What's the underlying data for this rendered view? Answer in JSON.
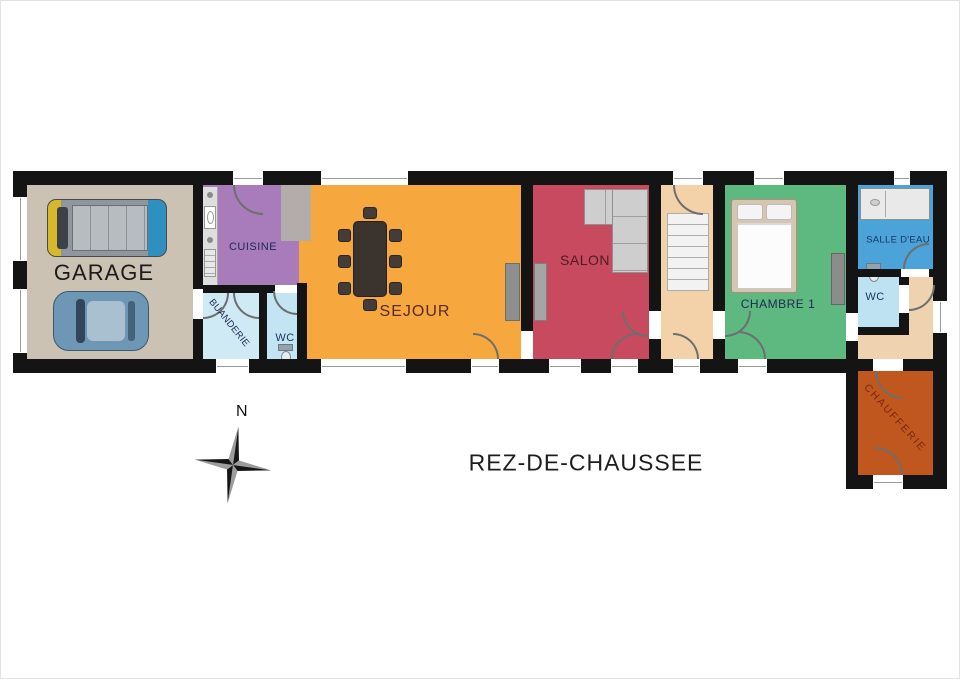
{
  "title": "REZ-DE-CHAUSSEE",
  "compass": {
    "north_label": "N"
  },
  "palette": {
    "wall": "#141414",
    "door_arc": "#6e6e6e",
    "window_frame": "#9a9a9a",
    "canvas": "#ffffff"
  },
  "rooms": {
    "garage": {
      "label": "GARAGE",
      "color": "#cbc2b3"
    },
    "cuisine": {
      "label": "CUISINE",
      "color": "#a87cbb"
    },
    "buanderie": {
      "label": "BUANDERIE",
      "color": "#cfeaf5"
    },
    "wc_buanderie": {
      "label": "WC",
      "color": "#c3e4f2"
    },
    "sejour": {
      "label": "SEJOUR",
      "color": "#f6a83e"
    },
    "salon": {
      "label": "SALON",
      "color": "#c84a5e"
    },
    "entree": {
      "color": "#f3d2a9"
    },
    "chambre1": {
      "label": "CHAMBRE 1",
      "color": "#5eb981"
    },
    "salle_deau": {
      "label": "SALLE D'EAU",
      "color": "#4ba3d9"
    },
    "wc_2": {
      "label": "WC",
      "color": "#bfe2f2"
    },
    "degagement": {
      "color": "#efd2b0"
    },
    "chaufferie": {
      "label": "CHAUFFERIE",
      "color": "#c0571e"
    }
  },
  "furniture": {
    "garage": [
      "van",
      "car"
    ],
    "cuisine": "kitchen-counter",
    "sejour": "dining-table-8-chairs",
    "salon": "corner-sofa",
    "entree": "staircase",
    "chambre1": [
      "double-bed",
      "wardrobe"
    ],
    "salle_deau": "shower",
    "wc_buanderie": "toilet",
    "wc_2": "toilet"
  }
}
